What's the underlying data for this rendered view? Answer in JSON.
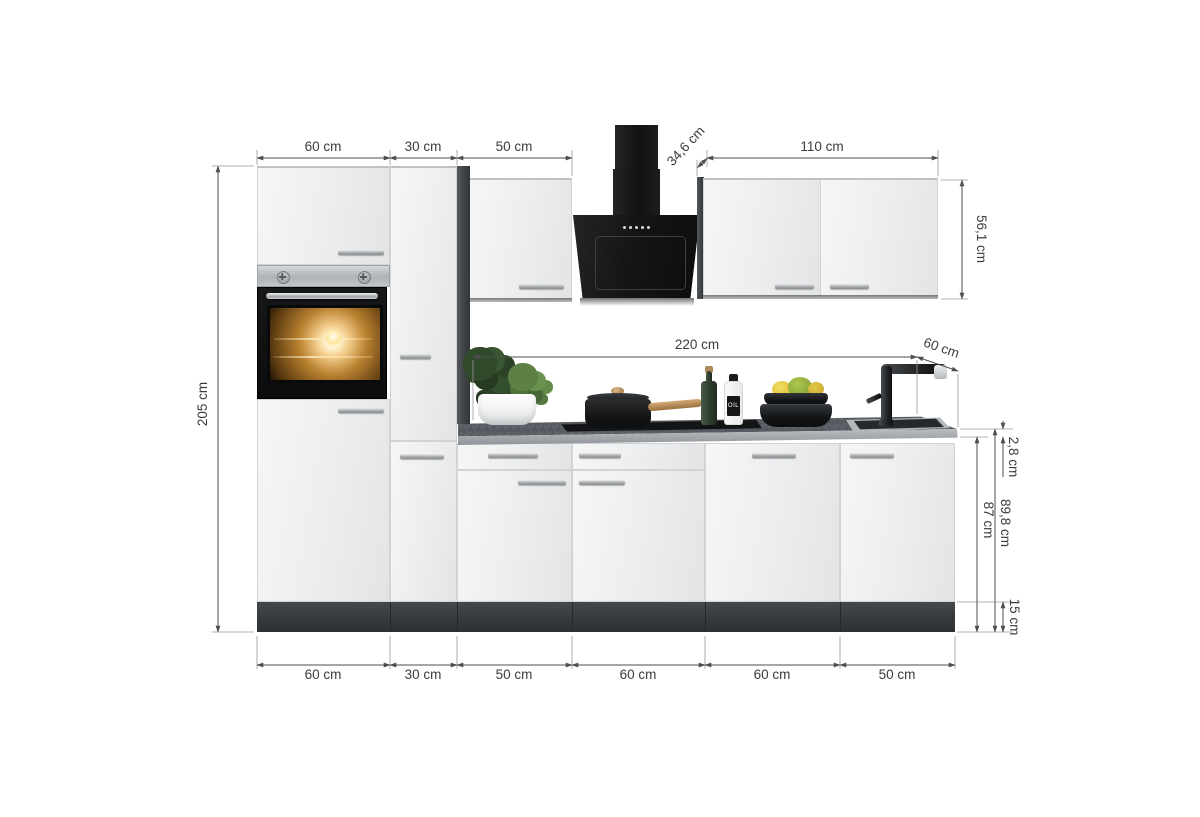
{
  "scene": {
    "description": "3D product rendering of a white kitchen cabinet set with anthracite carcass, built-in oven, black chimney range hood, worktop with cooktop and sink, annotated with dimension lines"
  },
  "dims": {
    "top": [
      "60 cm",
      "30 cm",
      "50 cm"
    ],
    "hood_depth": "34,6 cm",
    "wall_width": "110 cm",
    "wall_height": "56,1 cm",
    "tall_height": "205 cm",
    "worktop_length": "220 cm",
    "worktop_depth": "60 cm",
    "worktop_thickness": "2,8 cm",
    "base_height": "87 cm",
    "base_total_height": "89,8 cm",
    "plinth_height": "15 cm",
    "bottom": [
      "60 cm",
      "30 cm",
      "50 cm",
      "60 cm",
      "60 cm",
      "50 cm"
    ]
  },
  "measurements_cm": {
    "total_width": 310,
    "tall_unit_height": 205,
    "tall_units_widths": [
      60,
      30
    ],
    "base_units_widths": [
      50,
      60,
      60,
      50
    ],
    "wall_cabinet_width": 110,
    "wall_cabinet_height": 56.1,
    "hood_depth": 34.6,
    "worktop_length": 220,
    "worktop_depth": 60,
    "worktop_thickness": 2.8,
    "base_front_height": 87,
    "base_height_with_worktop": 89.8,
    "plinth_height": 15
  },
  "props": {
    "oil_bottle_label": "OIL"
  },
  "colors": {
    "background": "#ffffff",
    "front": "#efefef",
    "carcass_dark": "#45484b",
    "plinth": "#3a3e41",
    "worktop": "#5b6066",
    "hood_black": "#141416",
    "dimension_line": "#4e4e4e",
    "dimension_text": "#3b3b3b"
  }
}
